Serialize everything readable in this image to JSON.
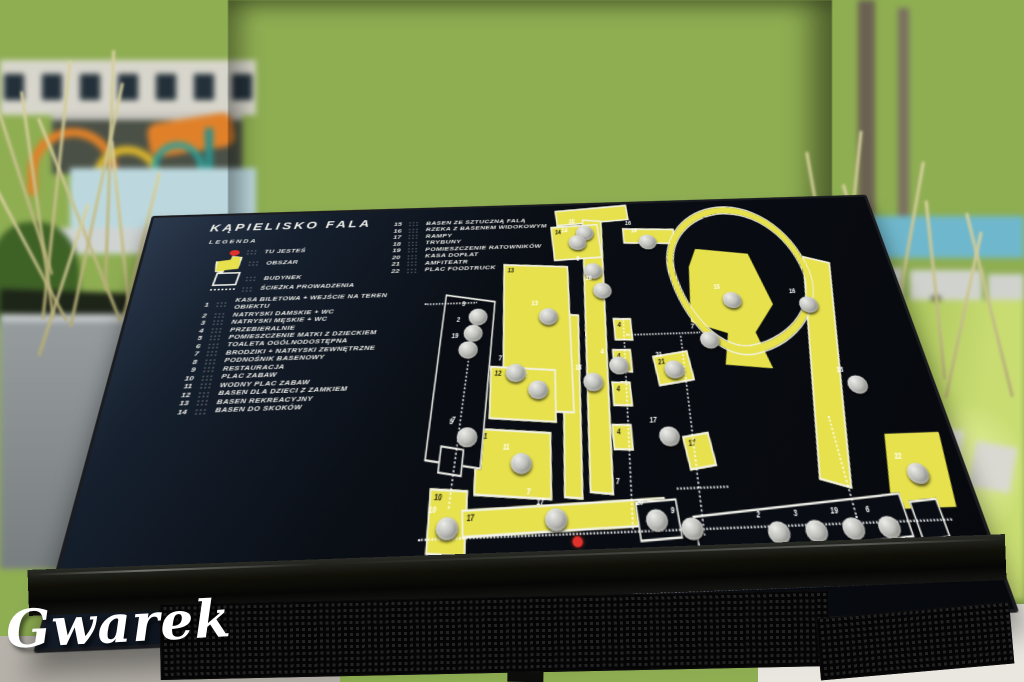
{
  "watermark": "Gwarek",
  "board": {
    "title": "KĄPIELISKO FALA",
    "legend_heading": "LEGENDA",
    "symbol_items": [
      {
        "symbol": "you-are-here",
        "label": "TU JESTEŚ"
      },
      {
        "symbol": "area",
        "label": "OBSZAR"
      },
      {
        "symbol": "building",
        "label": "BUDYNEK"
      },
      {
        "symbol": "path",
        "label": "ŚCIEŻKA PROWADZENIA"
      }
    ],
    "numbered_items": [
      {
        "num": "1",
        "label": "KASA BILETOWA + WEJŚCIE NA TEREN OBIEKTU"
      },
      {
        "num": "2",
        "label": "NATRYSKI DAMSKIE + WC"
      },
      {
        "num": "3",
        "label": "NATRYSKI MĘSKIE + WC"
      },
      {
        "num": "4",
        "label": "PRZEBIERALNIE"
      },
      {
        "num": "5",
        "label": "POMIESZCZENIE MATKI Z DZIECKIEM"
      },
      {
        "num": "6",
        "label": "TOALETA OGÓLNODOSTĘPNA"
      },
      {
        "num": "7",
        "label": "BRODZIKI + NATRYSKI ZEWNĘTRZNE"
      },
      {
        "num": "8",
        "label": "PODNOŚNIK BASENOWY"
      },
      {
        "num": "9",
        "label": "RESTAURACJA"
      },
      {
        "num": "10",
        "label": "PLAC ZABAW"
      },
      {
        "num": "11",
        "label": "WODNY PLAC ZABAW"
      },
      {
        "num": "12",
        "label": "BASEN DLA DZIECI Z ZAMKIEM"
      },
      {
        "num": "13",
        "label": "BASEN REKREACYJNY"
      },
      {
        "num": "14",
        "label": "BASEN DO SKOKÓW"
      }
    ],
    "numbered_items_col2": [
      {
        "num": "15",
        "label": "BASEN ZE SZTUCZNĄ FALĄ"
      },
      {
        "num": "16",
        "label": "RZEKA Z BASENEM WIDOKOWYM"
      },
      {
        "num": "17",
        "label": "RAMPY"
      },
      {
        "num": "18",
        "label": "TRYBUNY"
      },
      {
        "num": "19",
        "label": "POMIESZCZENIE RATOWNIKÓW"
      },
      {
        "num": "20",
        "label": "KASA DOPŁAT"
      },
      {
        "num": "21",
        "label": "AMFITEATR"
      },
      {
        "num": "22",
        "label": "PLAC FOODTRUCK"
      }
    ]
  },
  "map": {
    "areas": [
      {
        "num": "",
        "x": 180,
        "y": 4,
        "w": 104,
        "h": 17,
        "rot": -3
      },
      {
        "num": "",
        "x": 206,
        "y": 20,
        "w": 25,
        "h": 292,
        "rot": 5
      },
      {
        "num": "",
        "x": 170,
        "y": 135,
        "w": 19,
        "h": 180,
        "rot": 5
      },
      {
        "num": "",
        "x": 276,
        "y": 34,
        "w": 72,
        "h": 16,
        "rot": 2
      },
      {
        "num": "",
        "x": 500,
        "y": 76,
        "w": 34,
        "h": 238,
        "rot": 14
      },
      {
        "num": "14",
        "x": 172,
        "y": 27,
        "w": 66,
        "h": 40,
        "rot": -2
      },
      {
        "num": "13",
        "x": 96,
        "y": 76,
        "w": 88,
        "h": 158,
        "rot": 3
      },
      {
        "num": "12",
        "x": 76,
        "y": 192,
        "w": 82,
        "h": 50,
        "rot": 4
      },
      {
        "num": "11",
        "x": 56,
        "y": 254,
        "w": 90,
        "h": 58,
        "rot": 4
      },
      {
        "num": "10",
        "x": 0,
        "y": 306,
        "w": 42,
        "h": 52,
        "rot": 4
      },
      {
        "num": "17",
        "x": 40,
        "y": 322,
        "w": 238,
        "h": 20,
        "rot": -1
      },
      {
        "num": "22",
        "x": 548,
        "y": 270,
        "w": 88,
        "h": 68,
        "rot": 0,
        "shape": "trap"
      },
      {
        "num": "15",
        "x": 352,
        "y": 62,
        "w": 118,
        "h": 140,
        "rot": 0,
        "shape": "blob"
      },
      {
        "num": "",
        "x": 336,
        "y": 8,
        "w": 180,
        "h": 160,
        "rot": -8,
        "shape": "loop"
      },
      {
        "num": "21",
        "x": 294,
        "y": 182,
        "w": 44,
        "h": 28,
        "rot": -6
      },
      {
        "num": "17",
        "x": 316,
        "y": 264,
        "w": 30,
        "h": 28,
        "rot": -6
      },
      {
        "num": "4",
        "x": 246,
        "y": 142,
        "w": 21,
        "h": 21,
        "rot": 2
      },
      {
        "num": "4",
        "x": 240,
        "y": 176,
        "w": 21,
        "h": 21,
        "rot": 2
      },
      {
        "num": "4",
        "x": 234,
        "y": 210,
        "w": 21,
        "h": 21,
        "rot": 2
      },
      {
        "num": "4",
        "x": 228,
        "y": 252,
        "w": 21,
        "h": 21,
        "rot": 2
      }
    ],
    "buildings": [
      {
        "x": 6,
        "y": 112,
        "w": 66,
        "h": 170,
        "rot": 8
      },
      {
        "x": 12,
        "y": 268,
        "w": 26,
        "h": 22,
        "rot": 8
      },
      {
        "x": 246,
        "y": 322,
        "w": 46,
        "h": 30,
        "rot": -2
      },
      {
        "x": 312,
        "y": 330,
        "w": 248,
        "h": 34,
        "rot": -3
      },
      {
        "x": 572,
        "y": 330,
        "w": 30,
        "h": 30,
        "rot": -3
      }
    ],
    "paths": [
      {
        "x": -10,
        "y": 347,
        "len": 625,
        "rot": 0
      },
      {
        "x": 230,
        "y": 395,
        "len": 330,
        "rot": 0
      },
      {
        "x": 262,
        "y": 142,
        "len": 205,
        "rot": 96
      },
      {
        "x": 336,
        "y": 164,
        "len": 190,
        "rot": 94
      },
      {
        "x": 262,
        "y": 160,
        "len": 100,
        "rot": 0
      },
      {
        "x": 60,
        "y": 128,
        "len": 198,
        "rot": 100
      },
      {
        "x": -10,
        "y": 118,
        "len": 72,
        "rot": 0
      },
      {
        "x": 505,
        "y": 252,
        "len": 92,
        "rot": 90
      },
      {
        "x": 298,
        "y": 312,
        "len": 62,
        "rot": 0
      }
    ],
    "buttons": [
      {
        "num": "15",
        "x": 208,
        "y": 28
      },
      {
        "num": "14",
        "x": 196,
        "y": 40
      },
      {
        "num": "8",
        "x": 214,
        "y": 76
      },
      {
        "num": "16",
        "x": 224,
        "y": 100
      },
      {
        "num": "18",
        "x": 198,
        "y": 200
      },
      {
        "num": "13",
        "x": 146,
        "y": 128
      },
      {
        "num": "12",
        "x": 126,
        "y": 206
      },
      {
        "num": "11",
        "x": 100,
        "y": 276
      },
      {
        "num": "10",
        "x": 10,
        "y": 330
      },
      {
        "num": "17",
        "x": 138,
        "y": 326
      },
      {
        "num": "3",
        "x": 50,
        "y": 126
      },
      {
        "num": "2",
        "x": 43,
        "y": 144
      },
      {
        "num": "19",
        "x": 36,
        "y": 162
      },
      {
        "num": "5",
        "x": 34,
        "y": 250
      },
      {
        "num": "7",
        "x": 98,
        "y": 188
      },
      {
        "num": "16",
        "x": 298,
        "y": 42
      },
      {
        "num": "15",
        "x": 402,
        "y": 116
      },
      {
        "num": "7",
        "x": 360,
        "y": 160
      },
      {
        "num": "4",
        "x": 234,
        "y": 184
      },
      {
        "num": "21",
        "x": 306,
        "y": 190
      },
      {
        "num": "16",
        "x": 506,
        "y": 124
      },
      {
        "num": "18",
        "x": 540,
        "y": 212
      },
      {
        "num": "17",
        "x": 286,
        "y": 256
      },
      {
        "num": "20",
        "x": 256,
        "y": 330
      },
      {
        "num": "9",
        "x": 296,
        "y": 338
      },
      {
        "num": "1",
        "x": 264,
        "y": 372
      },
      {
        "num": "2",
        "x": 396,
        "y": 344
      },
      {
        "num": "3",
        "x": 440,
        "y": 344
      },
      {
        "num": "19",
        "x": 484,
        "y": 343
      },
      {
        "num": "6",
        "x": 526,
        "y": 343
      },
      {
        "num": "22",
        "x": 580,
        "y": 298
      }
    ],
    "labels": [
      {
        "t": "7",
        "x": 28,
        "y": 238
      },
      {
        "t": "7",
        "x": 118,
        "y": 306
      },
      {
        "t": "7",
        "x": 226,
        "y": 300
      },
      {
        "t": "16",
        "x": 398,
        "y": 20,
        "c": "dark"
      },
      {
        "t": "16",
        "x": 282,
        "y": 22
      }
    ],
    "you_are_here": {
      "x": 168,
      "y": 350
    }
  },
  "colors": {
    "board_bg": "#0a0e15",
    "area_yellow": "#e7e14d",
    "outline_white": "#f2f2ea",
    "marker_red": "#e1322b",
    "button_metal": "#bcbcb8"
  }
}
